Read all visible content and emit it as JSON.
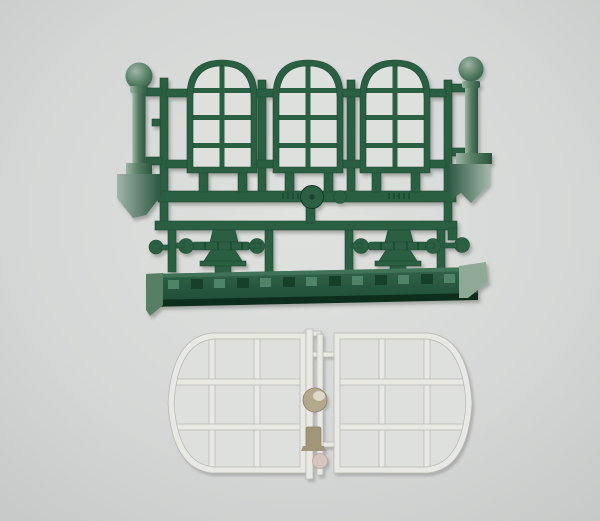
{
  "image": {
    "subject": "Model kit sprues: dark green sprue with three arched windows, two ball-top posts, two handrails and a platform base strip; below, a white sprue with two round-edged multi-pane window frames joined by a runner with an injection disc",
    "width": 600,
    "height": 521
  },
  "colors": {
    "background_center": "#e0e2e0",
    "background_mid": "#d5d7d6",
    "background_edge": "#c6c8c7",
    "green_frame": "#2b5e43",
    "green_dark": "#17402b",
    "post_light": "#9fb5a7",
    "post_mid": "#567f63",
    "post_dark": "#2b5540",
    "strip_top": "#336449",
    "strip_bottom": "#1d4c36",
    "strip_edge_dark": "#0e2f1e",
    "strip_detail_light": "#4f8468",
    "strip_detail_dark": "#16402b",
    "strip_cap_light": "#8fa996",
    "glass": "#dee0de",
    "white_frame": "#e8e8e4",
    "tan": "#b3a78c",
    "tan_dark": "#a2957a",
    "tan_highlight": "#ded8c6",
    "pink": "#d6c5bf"
  },
  "parts": {
    "green_sprue": {
      "label": "Green sprue with station wall parts"
    },
    "arched_window": {
      "label": "Arched 8-pane window",
      "count": 3
    },
    "post": {
      "label": "Post with ball finial",
      "count": 2
    },
    "handrail": {
      "label": "Handrail with ball ends",
      "count": 2
    },
    "base_strip": {
      "label": "Platform base strip",
      "count": 1
    },
    "white_sprue": {
      "label": "White sprue with rounded window frames"
    },
    "round_window": {
      "label": "Round-edged 9-pane window frame",
      "count": 2
    },
    "connector": {
      "label": "Sprue runner with injection-point disc"
    }
  }
}
